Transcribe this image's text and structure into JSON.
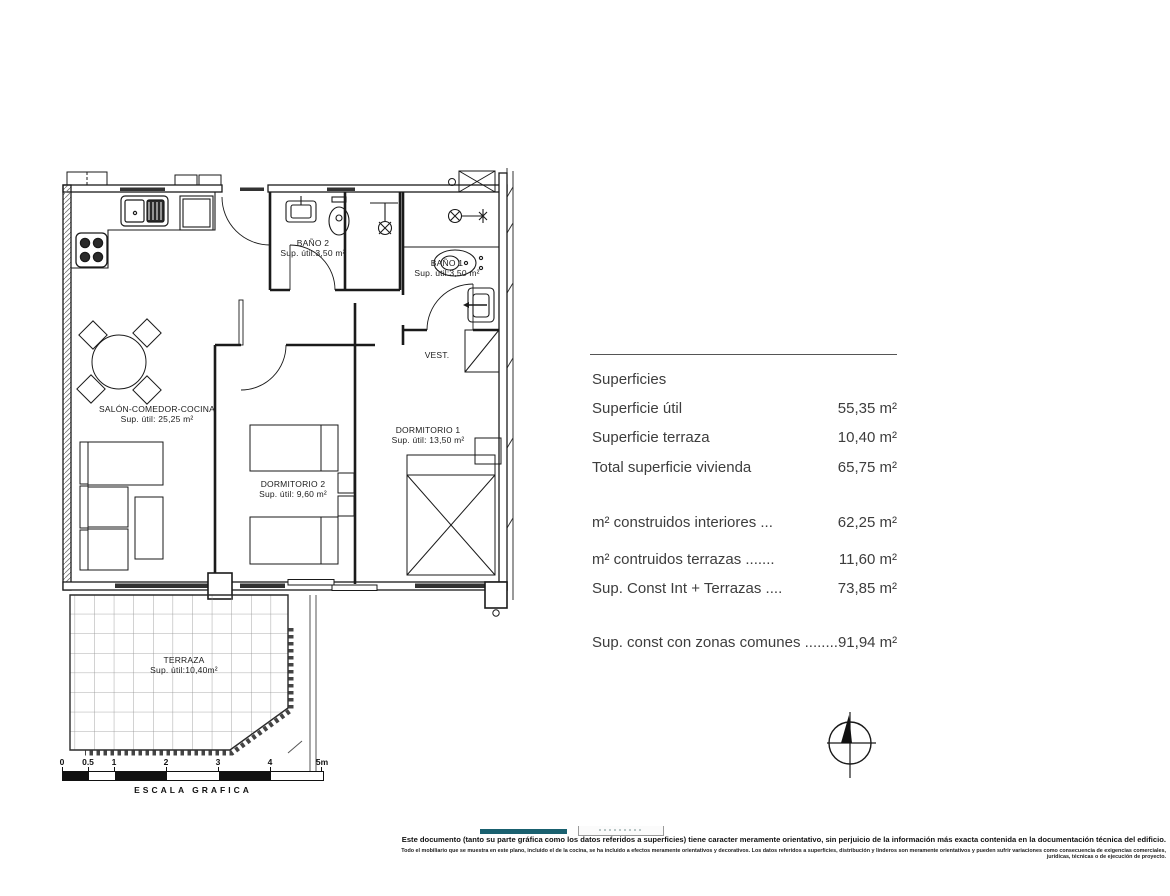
{
  "plan": {
    "rooms": {
      "salon": {
        "name": "SALÓN-COMEDOR-COCINA",
        "area": "Sup. útil: 25,25 m²"
      },
      "dormitorio1": {
        "name": "DORMITORIO 1",
        "area": "Sup. útil: 13,50 m²"
      },
      "dormitorio2": {
        "name": "DORMITORIO 2",
        "area": "Sup. útil: 9,60 m²"
      },
      "bano1": {
        "name": "BAÑO 1",
        "area": "Sup. útil:3,50 m²"
      },
      "bano2": {
        "name": "BAÑO 2",
        "area": "Sup. útil:3,50 m²"
      },
      "vestibulo": {
        "name": "VEST."
      },
      "terraza": {
        "name": "TERRAZA",
        "area": "Sup. útil:10,40m²"
      }
    }
  },
  "surfaces_table": {
    "title": "Superficies",
    "rows": [
      {
        "label": "Superficie útil",
        "value": "55,35 m²"
      },
      {
        "label": "Superficie terraza",
        "value": "10,40 m²"
      },
      {
        "label": "Total superficie vivienda",
        "value": "65,75 m²"
      },
      {
        "label": "m² construidos interiores ...",
        "value": "62,25 m²"
      },
      {
        "label": "m² contruidos terrazas .......",
        "value": "11,60 m²"
      },
      {
        "label": "Sup. Const Int + Terrazas ....",
        "value": "73,85 m²"
      },
      {
        "label": "Sup. const con zonas comunes ........",
        "value": "91,94 m²"
      }
    ]
  },
  "scale_bar": {
    "ticks": [
      "0",
      "0.5",
      "1",
      "2",
      "3",
      "4",
      "5m"
    ],
    "label": "ESCALA GRAFICA"
  },
  "disclaimer": {
    "line1": "Este documento (tanto su parte gráfica como los datos referidos a superficies) tiene caracter meramente orientativo, sin perjuicio de la información más exacta contenida en la documentación técnica del edificio.",
    "line2": "Todo el mobiliario que se muestra en este plano, incluido el de la cocina, se ha incluido a efectos meramente orientativos y decorativos. Los datos referidos a superficies, distribución y linderos son meramente orientativos y pueden sufrir variaciones como consecuencia de exigencias comerciales, jurídicas, técnicas o de ejecución de proyecto.",
    "accent_color": "#19606f"
  }
}
